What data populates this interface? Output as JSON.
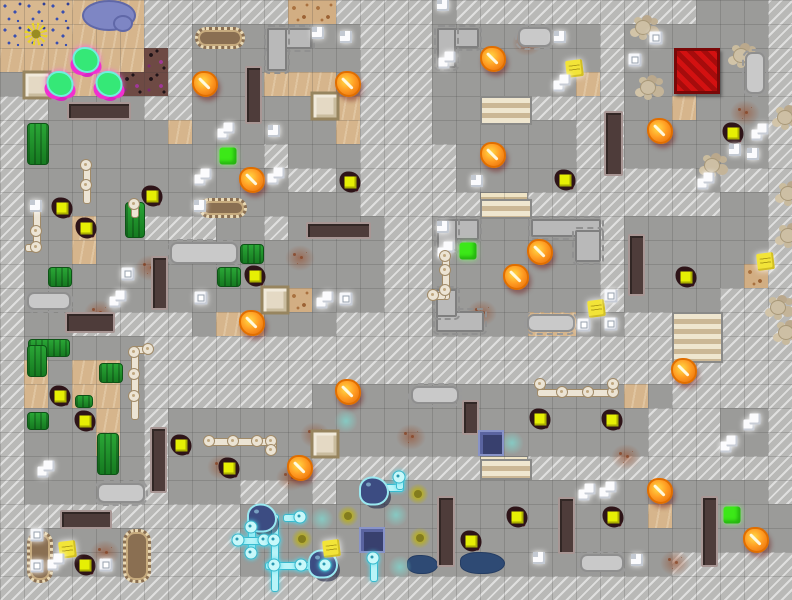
{
  "map": {
    "cols": 33,
    "rows": 25,
    "tile": 24,
    "terrain_legend": {
      ".": "gray-floor",
      "s": "sand",
      "S": "sand-debris",
      "B": "sand-blue-specks",
      "P": "dark-gravel-purple",
      "t": "stairs-strip",
      "#": "hatched-wall-unexplored"
    },
    "palette": {
      "floor": "#9b9b99",
      "hatch": "#b9b9b7",
      "sand": "#d6b58c",
      "fire": "#ff9c22",
      "zombie_body": "#e6ef04",
      "gore": "#2e1418",
      "note": "#f2e438",
      "medkit": "#3ce818",
      "green_slime": "#35e877",
      "slime_glow": "#f030d0",
      "navy_slime": "#3c4c82",
      "cyan_pipe": "#b8f4f8",
      "bone_pipe": "#ece4d4",
      "bench": "#4e3c3a",
      "red_mat": "#d31111",
      "water": "#7e86c4",
      "puddle": "#2e4a74",
      "crop": "#1f8a28"
    },
    "terrain_rows": [
      "BBBsss######SS####.##########...#",
      "BBBsss##.......###.......#......#",
      "ssssssP#.......###.......#......#",
      "..sssPP#...sss.###......s#......#",
      "##....##.....ss###..tt####..s...#",
      "#......s......s###......##......#",
      "#..........#...####.....##......#",
      "#...........##.####.....#####.###",
      "#..............#####tt########..#",
      "#..s..###..#....##.......#......#",
      "#..s............##.......#......#",
      "#...............##.......#.....S#",
      "#...........S...##.......#....###",
      "#..#####.ss...####....ss..##tt###",
      "#.....######################tt###",
      "#s.ss.###########################",
      "#s.ss.#######.............s.#####",
      "#...s.#....................###..#",
      "#...s.#....................###..#",
      "#.....#......#######tt###########",
      "#.....#...##.#..................#",
      "##########.................s.....",
      "#.....####.......................",
      "#.....####..................#####",
      "#################################"
    ]
  },
  "sprites": {
    "fires": [
      [
        205,
        84
      ],
      [
        252,
        180
      ],
      [
        348,
        84
      ],
      [
        493,
        59
      ],
      [
        493,
        155
      ],
      [
        660,
        131
      ],
      [
        540,
        252
      ],
      [
        516,
        277
      ],
      [
        252,
        323
      ],
      [
        348,
        392
      ],
      [
        300,
        468
      ],
      [
        684,
        371
      ],
      [
        660,
        491
      ],
      [
        756,
        540
      ]
    ],
    "zombies": [
      [
        62,
        208
      ],
      [
        86,
        228
      ],
      [
        255,
        276
      ],
      [
        350,
        182
      ],
      [
        565,
        180
      ],
      [
        733,
        133
      ],
      [
        686,
        277
      ],
      [
        540,
        419
      ],
      [
        612,
        420
      ],
      [
        613,
        517
      ],
      [
        471,
        541
      ],
      [
        517,
        517
      ],
      [
        85,
        565
      ],
      [
        60,
        396
      ],
      [
        85,
        421
      ],
      [
        181,
        445
      ],
      [
        229,
        468
      ],
      [
        152,
        196
      ]
    ],
    "notes": [
      [
        566,
        60
      ],
      [
        757,
        253
      ],
      [
        588,
        300
      ],
      [
        323,
        540
      ],
      [
        59,
        541
      ]
    ],
    "medkits": [
      [
        228,
        156
      ],
      [
        468,
        251
      ],
      [
        732,
        515
      ]
    ],
    "paper_pairs": [
      [
        226,
        131
      ],
      [
        203,
        177
      ],
      [
        562,
        83
      ],
      [
        447,
        60
      ],
      [
        118,
        299
      ],
      [
        56,
        562
      ],
      [
        587,
        492
      ],
      [
        608,
        490
      ],
      [
        760,
        132
      ],
      [
        706,
        181
      ],
      [
        446,
        250
      ],
      [
        46,
        469
      ],
      [
        325,
        300
      ],
      [
        729,
        444
      ],
      [
        752,
        422
      ],
      [
        276,
        176
      ]
    ],
    "papers": [
      [
        318,
        33
      ],
      [
        346,
        37
      ],
      [
        274,
        131
      ],
      [
        443,
        5
      ],
      [
        477,
        181
      ],
      [
        560,
        37
      ],
      [
        735,
        150
      ],
      [
        753,
        154
      ],
      [
        36,
        206
      ],
      [
        200,
        206
      ],
      [
        539,
        558
      ],
      [
        637,
        560
      ],
      [
        443,
        227
      ]
    ],
    "box_icons": [
      [
        656,
        38
      ],
      [
        635,
        60
      ],
      [
        128,
        274
      ],
      [
        201,
        298
      ],
      [
        346,
        299
      ],
      [
        611,
        296
      ],
      [
        584,
        325
      ],
      [
        611,
        324
      ],
      [
        37,
        535
      ],
      [
        37,
        566
      ],
      [
        106,
        565
      ]
    ],
    "crates": [
      [
        37,
        85
      ],
      [
        325,
        106
      ],
      [
        275,
        300
      ],
      [
        325,
        444
      ]
    ],
    "navy_crates": [
      [
        491,
        443
      ],
      [
        372,
        540
      ]
    ],
    "red_mats": [
      [
        697,
        71
      ]
    ],
    "glows": [
      [
        346,
        421
      ],
      [
        512,
        443
      ],
      [
        322,
        519
      ],
      [
        396,
        515
      ],
      [
        400,
        567
      ]
    ],
    "acid_splats": [
      [
        348,
        516
      ],
      [
        302,
        539
      ],
      [
        418,
        494
      ],
      [
        420,
        538
      ]
    ],
    "navy_slimes": [
      [
        374,
        491
      ],
      [
        262,
        518
      ],
      [
        323,
        564
      ]
    ],
    "green_slimes": [
      [
        86,
        60
      ],
      [
        60,
        84
      ],
      [
        109,
        84
      ]
    ],
    "flowers": [
      [
        36,
        34
      ]
    ],
    "pond": [
      [
        82,
        0,
        50,
        27
      ],
      [
        113,
        15,
        16,
        13
      ]
    ],
    "rust": [
      [
        135,
        255
      ],
      [
        84,
        300
      ],
      [
        467,
        300
      ],
      [
        611,
        444
      ],
      [
        660,
        550
      ],
      [
        207,
        454
      ],
      [
        396,
        424
      ],
      [
        276,
        465
      ],
      [
        90,
        540
      ],
      [
        512,
        30
      ],
      [
        730,
        100
      ],
      [
        285,
        245
      ],
      [
        300,
        422
      ]
    ],
    "rubble": [
      [
        635,
        20
      ],
      [
        733,
        48
      ],
      [
        640,
        80
      ],
      [
        777,
        110
      ],
      [
        704,
        158
      ],
      [
        780,
        186
      ],
      [
        780,
        228
      ],
      [
        770,
        300
      ],
      [
        778,
        325
      ]
    ],
    "puddles": [
      [
        407,
        555,
        29,
        17
      ],
      [
        460,
        552,
        43,
        20
      ]
    ],
    "crops": [
      [
        27,
        123,
        20,
        40
      ],
      [
        125,
        202,
        18,
        34
      ],
      [
        48,
        267,
        22,
        18
      ],
      [
        217,
        267,
        22,
        18
      ],
      [
        240,
        244,
        22,
        18
      ],
      [
        28,
        339,
        40,
        16
      ],
      [
        27,
        345,
        18,
        30
      ],
      [
        99,
        363,
        22,
        18
      ],
      [
        97,
        433,
        20,
        40
      ],
      [
        27,
        412,
        20,
        16
      ],
      [
        75,
        395,
        16,
        11
      ]
    ],
    "logs": [
      [
        195,
        27,
        44,
        16
      ],
      [
        199,
        198,
        42,
        14
      ],
      [
        27,
        531,
        20,
        46
      ],
      [
        123,
        529,
        22,
        48
      ]
    ],
    "tables": [
      [
        170,
        242,
        64,
        18
      ],
      [
        27,
        292,
        40,
        14
      ],
      [
        97,
        483,
        44,
        16
      ],
      [
        580,
        554,
        40,
        14
      ],
      [
        411,
        386,
        44,
        14
      ],
      [
        527,
        314,
        44,
        14
      ],
      [
        745,
        52,
        16,
        38
      ],
      [
        518,
        27,
        30,
        16
      ]
    ],
    "counters": [
      [
        267,
        28,
        41,
        17
      ],
      [
        267,
        28,
        16,
        39
      ],
      [
        437,
        28,
        38,
        16
      ],
      [
        437,
        28,
        15,
        36
      ],
      [
        437,
        219,
        38,
        17
      ],
      [
        437,
        219,
        16,
        28
      ],
      [
        436,
        311,
        44,
        17
      ],
      [
        436,
        289,
        17,
        24
      ],
      [
        531,
        219,
        66,
        14
      ],
      [
        575,
        230,
        22,
        28
      ]
    ],
    "benches": [
      [
        67,
        102,
        60,
        14
      ],
      [
        245,
        66,
        13,
        54
      ],
      [
        65,
        312,
        46,
        17
      ],
      [
        151,
        256,
        13,
        50
      ],
      [
        306,
        222,
        61,
        13
      ],
      [
        150,
        427,
        13,
        62
      ],
      [
        60,
        510,
        48,
        15
      ],
      [
        462,
        400,
        13,
        31
      ],
      [
        437,
        496,
        14,
        67
      ],
      [
        558,
        497,
        13,
        53
      ],
      [
        701,
        496,
        13,
        67
      ],
      [
        604,
        111,
        15,
        61
      ],
      [
        628,
        234,
        13,
        58
      ]
    ],
    "stairs": [
      [
        672,
        312,
        47,
        47
      ],
      [
        480,
        96,
        48,
        25
      ],
      [
        480,
        199,
        48,
        16
      ],
      [
        480,
        459,
        48,
        17
      ]
    ],
    "bone_pipe_segments": [
      [
        83,
        160,
        6,
        42
      ],
      [
        33,
        210,
        6,
        38
      ],
      [
        25,
        244,
        12,
        6
      ],
      [
        131,
        200,
        6,
        16
      ],
      [
        131,
        346,
        6,
        72
      ],
      [
        131,
        346,
        18,
        6
      ],
      [
        204,
        438,
        66,
        6
      ],
      [
        269,
        438,
        6,
        14
      ],
      [
        442,
        250,
        6,
        48
      ],
      [
        430,
        292,
        14,
        6
      ],
      [
        537,
        381,
        6,
        12
      ],
      [
        537,
        389,
        78,
        6
      ],
      [
        610,
        381,
        6,
        14
      ]
    ],
    "bone_pipe_joints": [
      [
        86,
        165
      ],
      [
        86,
        185
      ],
      [
        36,
        231
      ],
      [
        36,
        247
      ],
      [
        134,
        204
      ],
      [
        134,
        352
      ],
      [
        134,
        374
      ],
      [
        134,
        396
      ],
      [
        148,
        349
      ],
      [
        209,
        441
      ],
      [
        233,
        441
      ],
      [
        257,
        441
      ],
      [
        271,
        441
      ],
      [
        271,
        450
      ],
      [
        445,
        256
      ],
      [
        445,
        270
      ],
      [
        445,
        290
      ],
      [
        433,
        295
      ],
      [
        540,
        384
      ],
      [
        562,
        392
      ],
      [
        588,
        392
      ],
      [
        613,
        392
      ],
      [
        613,
        384
      ]
    ],
    "cyan_pipe_segments": [
      [
        248,
        524,
        6,
        32
      ],
      [
        236,
        537,
        32,
        6
      ],
      [
        271,
        514,
        6,
        52
      ],
      [
        283,
        514,
        20,
        6
      ],
      [
        265,
        562,
        62,
        6
      ],
      [
        271,
        566,
        6,
        24
      ],
      [
        370,
        556,
        6,
        24
      ],
      [
        382,
        484,
        20,
        6
      ],
      [
        396,
        474,
        6,
        14
      ]
    ],
    "cyan_pipe_joints": [
      [
        251,
        527
      ],
      [
        251,
        553
      ],
      [
        238,
        540
      ],
      [
        264,
        540
      ],
      [
        274,
        540
      ],
      [
        274,
        565
      ],
      [
        300,
        517
      ],
      [
        301,
        565
      ],
      [
        325,
        565
      ],
      [
        373,
        558
      ],
      [
        399,
        477
      ]
    ]
  }
}
